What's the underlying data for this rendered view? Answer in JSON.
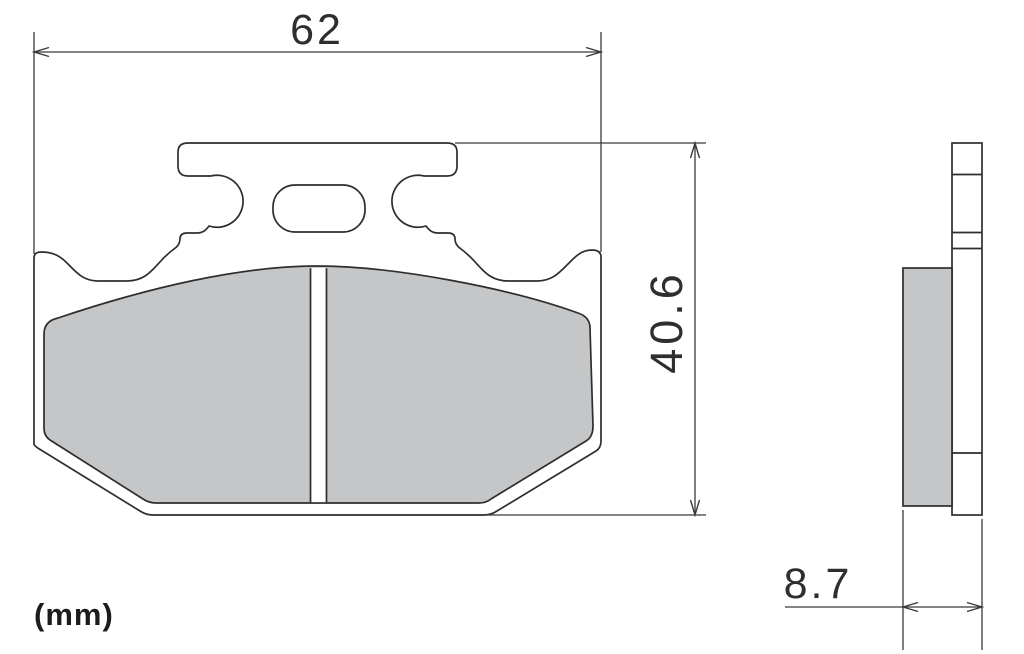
{
  "drawing": {
    "subject": "brake-pad-dimensional-drawing",
    "unit_label": "(mm)",
    "dimensions": {
      "width": "62",
      "height": "40.6",
      "thickness": "8.7"
    }
  },
  "colors": {
    "background": "#ffffff",
    "plate": "#ffffff",
    "friction": "#c5c6c8",
    "line": "#2e2e2e",
    "dimline": "#3a3a3a"
  }
}
